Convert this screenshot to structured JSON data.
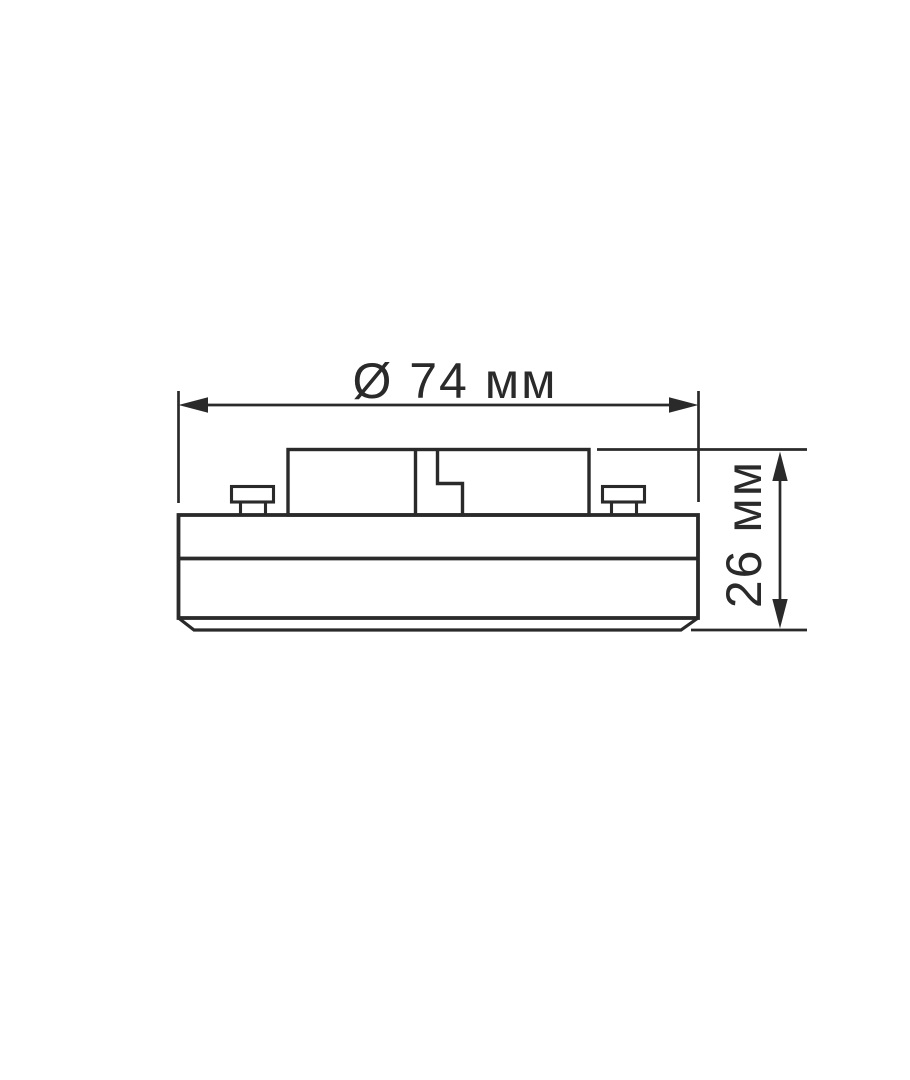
{
  "page": {
    "background": "#ffffff"
  },
  "drawing": {
    "colors": {
      "line": "#2a2a2a",
      "background": "#ffffff"
    },
    "labels": {
      "diameter": "Ø 74 мм",
      "height": "26 мм"
    },
    "values": {
      "diameter_symbol": "Ø",
      "diameter": 74,
      "height": 26,
      "unit": "мм"
    }
  }
}
